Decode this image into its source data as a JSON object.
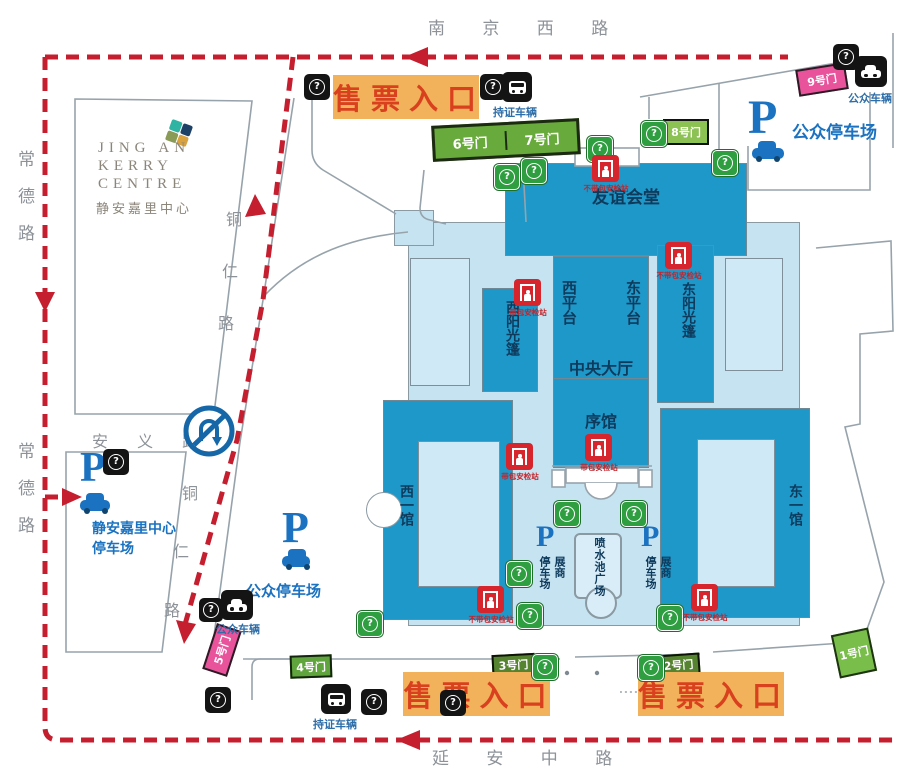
{
  "roads": {
    "nanjing_west": "南 京 西 路",
    "yanan_middle": "延 安 中 路",
    "changde": "常德路",
    "anyi": "安 义 路",
    "tongren_chars": [
      "铜",
      "仁",
      "路"
    ]
  },
  "ticket_entrance": "售票入口",
  "gates": {
    "gate1": "1号门",
    "gate2": "2号门",
    "gate3": "3号门",
    "gate4": "4号门",
    "gate5": "5号门",
    "gate6": "6号门",
    "gate7": "7号门",
    "gate8": "8号门",
    "gate9": "9号门"
  },
  "kerry_logo": {
    "en1": "JING AN",
    "en2": "KERRY",
    "en3": "CENTRE",
    "cn": "静安嘉里中心"
  },
  "parking": {
    "p": "P",
    "public_label": "公众停车场",
    "kerry_line1": "静安嘉里中心",
    "kerry_line2": "停车场",
    "exhibitor_col_right": "展商",
    "exhibitor_col_left": "停车场"
  },
  "vehicles": {
    "permit": "持证车辆",
    "public": "公众车辆"
  },
  "security": {
    "no_bag": "不带包安检站",
    "with_bag": "带包安检站"
  },
  "buildings": {
    "friendship_hall": "友谊会堂",
    "west_terrace": "西平台",
    "east_terrace": "东平台",
    "central_hall": "中央大厅",
    "preface_hall": "序馆",
    "west_sunshade": "西阳光篷",
    "east_sunshade": "东阳光篷",
    "west_hall_1": "西一馆",
    "east_hall_1": "东一馆",
    "fountain_plaza": "喷水池广场"
  },
  "icons": {
    "question_glyph": "?",
    "no_u_turn": "no-u-turn-sign"
  },
  "colors": {
    "route_red": "#c41e2f",
    "entrance_bg": "#f2b25c",
    "entrance_text": "#d9411e",
    "building_medium": "#1e98c9",
    "building_light": "#c6e3f2",
    "gate_green": "#69aa3c",
    "gate_pink": "#e8539b",
    "parking_blue": "#1a72c0",
    "icon_green": "#2f9e41",
    "icon_black": "#141414",
    "security_red": "#d6252c"
  }
}
